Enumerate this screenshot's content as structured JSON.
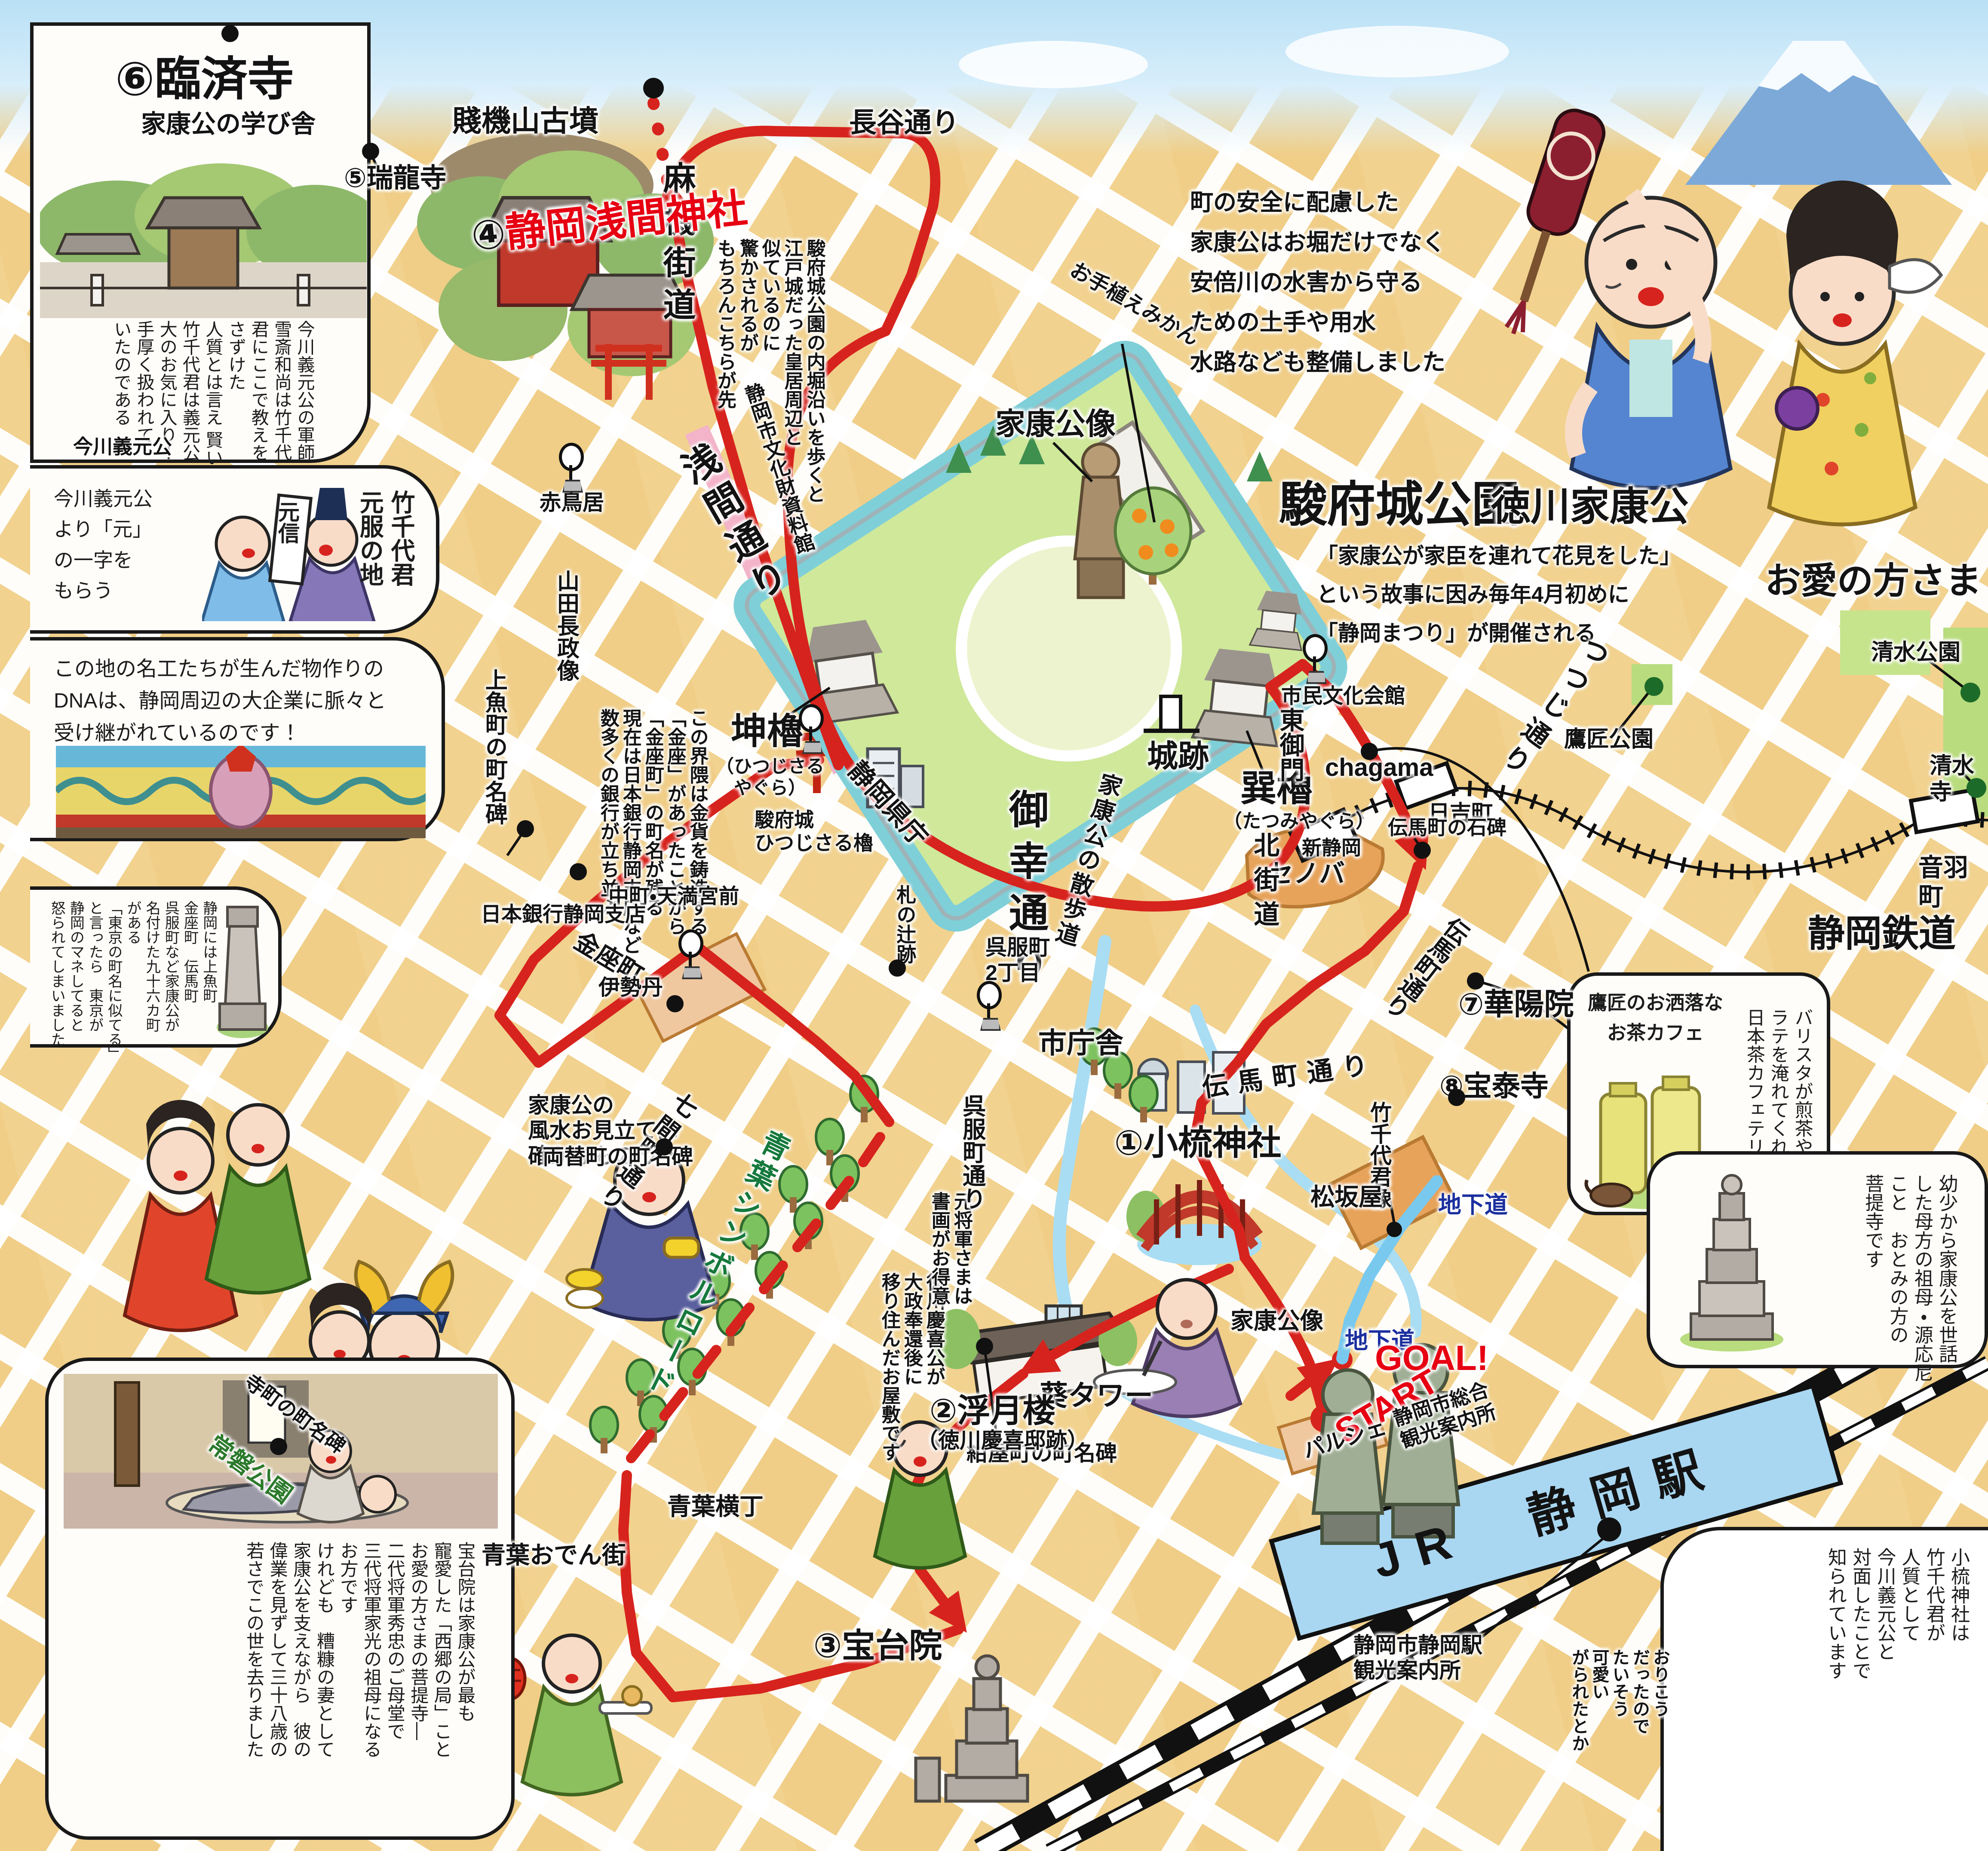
{
  "colors": {
    "route_red": "#d7231d",
    "accent_red": "#e60012",
    "label_blue": "#1b2f9e",
    "road_green": "#15793c",
    "moat_teal": "#7fcfd8",
    "block_yellow": "#f1d28e",
    "station_blue": "#a9d7f2",
    "cenova_orange": "#e8a35a"
  },
  "route": {
    "start": "START",
    "goal": "GOAL!"
  },
  "labels": {
    "kofun": "賤機山古墳",
    "hase": "長谷通り",
    "asahata": "麻機街道",
    "zuiryuji": "⑤瑞龍寺",
    "sengen_num": "④",
    "sengen": "静岡浅間神社",
    "sengen_dori": "浅間通り",
    "akatorii": "赤鳥居",
    "yamada": "山田長政像",
    "bunkazai": "静岡市文化財資料館",
    "uoichi": "上魚町の町名碑",
    "nakacho": "中町・天満宮前",
    "kinzacho": "金座町",
    "nichigin": "日本銀行静岡支店",
    "mikan": "お手植えみかん",
    "ieyasuzo_park": "家康公像",
    "sunpu": "駿府城公園",
    "shiroato": "城跡",
    "sanpo": "家康公の散歩道",
    "hitsujisaru": "坤櫓",
    "hitsujisaru_kana": "（ひつじさる\nやぐら）",
    "hitsujisaru_yagura": "駿府城\nひつじさる櫓",
    "tatsumi": "巽櫓",
    "tatsumi_kana": "（たつみやぐら）",
    "higashigomon": "東御門",
    "shimin": "市民文化会館",
    "miyuki": "御幸通り",
    "kencho": "静岡県庁",
    "shichosha": "市庁舎",
    "fudanotsuji": "札の辻跡",
    "isetan": "伊勢丹",
    "gofuku2": "呉服町\n2丁目",
    "gofuku_dori": "呉服町通り",
    "shichiken": "七間町通り",
    "ryogae": "両替町の町名碑",
    "aoba_road": "青葉シンボルロード",
    "aoba_yokocho": "青葉横丁",
    "aoba_oden": "青葉おでん街",
    "teramachi": "寺町の町名碑",
    "tokiwa": "常磐公園",
    "ieyasu_chara": "徳川家康公",
    "oai_chara": "お愛の方さま",
    "shimizu_park": "清水公園",
    "shimizudera": "清水寺",
    "otowa": "音羽町",
    "tetsudo": "静岡鉄道",
    "takajo": "鷹匠公園",
    "tsutsuji": "つつじ通り",
    "chagama": "chagama",
    "hiyoshi": "日吉町",
    "tenma_sekihi": "伝馬町の石碑",
    "kayoin": "⑦華陽院",
    "shin_shizuoka": "新静岡",
    "cenova": "セノバ",
    "kitakaido": "北街道",
    "tenma_dori": "伝馬町通り",
    "hotaiji": "⑧宝泰寺",
    "takechiyo_zo": "竹千代君像",
    "matsuzakaya": "松坂屋",
    "chikado_a": "地下道",
    "chikado_b": "地下道",
    "goal": "GOAL!",
    "start": "START",
    "sogo_annai": "静岡市総合\n観光案内所",
    "parche": "パルシェ",
    "jr_eki": "JR　静岡駅",
    "eki_annai": "静岡市静岡駅\n観光案内所",
    "aoi_tower": "葵タワー",
    "konya": "紺屋町の町名碑",
    "ogushi": "①小梳神社",
    "fugetsuro": "②浮月楼",
    "fugetsuro_kana": "（徳川慶喜邸跡）",
    "hodaiin": "③宝台院",
    "ieyasuzo_eki": "家康公像",
    "rinzaiji_caption": "今川義元公"
  },
  "panels": {
    "rinzaiji": {
      "title": "⑥臨済寺",
      "subtitle": "家康公の学び舎",
      "body": "今川義元公の軍師\n雪斎和尚は竹千代\n君にここで教えを\nさずけた\n人質とは言え 賢い\n竹千代君は義元公\n大のお気に入り！\n手厚く扱われて\nいたのである"
    },
    "genpuku": {
      "caption": "今川義元公\nより「元」\nの一字を\nもらう",
      "title": "竹千代君\n元服の地",
      "scroll": "元信"
    },
    "dna": {
      "body": "この地の名工たちが生んだ物作りの\nDNAは、静岡周辺の大企業に脈々と\n受け継がれているのです！"
    },
    "chomei": {
      "body": "静岡には上魚町\n金座町　伝馬町\n呉服町など家康公が\n名付けた九十六カ町\nがある\n「東京の町名に似てる」\nと言ったら　東京が\n静岡のマネしてると\n怒られてしまいました"
    },
    "hodaiin_story": {
      "body": "宝台院は家康公が最も\n寵愛した「西郷の局」こと\nお愛の方さまの菩提寺―\n二代将軍秀忠のご母堂で\n三代将軍家光の祖母になる\nお方です\nけれども　糟糠の妻として\n家康公を支えながら　彼の\n偉業を見ずして三十八歳の\n若さでこの世を去りました"
    },
    "tea_cafe": {
      "title": "鷹匠のお洒落な\nお茶カフェ",
      "body": "バリスタが煎茶や\nラテを淹れてくれる\n日本茶カフェテリア"
    },
    "genoni": {
      "body": "幼少から家康公を世話\nした母方の祖母・源応尼\nこと　おとみの方の\n菩提寺です"
    },
    "ogushi_note": {
      "body": "小梳神社は\n竹千代君が\n人質として\n今川義元公と\n対面したことで\n知られています"
    },
    "okoriko": {
      "body": "おりこう\nだったので\nたいそう\n可愛い\nがられたとか"
    },
    "anzen": {
      "body": "町の安全に配慮した\n家康公はお堀だけでなく\n安倍川の水害から守る\nための土手や用水\n水路なども整備しました"
    },
    "matsuri": {
      "body": "「家康公が家臣を連れて花見をした」\nという故事に因み毎年4月初めに\n「静岡まつり」が開催される"
    },
    "uchibori": {
      "body": "駿府城公園の内堀沿いを歩くと\n江戸城だった皇居周辺と\n似ているのに\n驚かされるが\nもちろんこちらが先"
    },
    "kinza": {
      "body": "この界隈は金貨を鋳造する\n「金座」があったことから\n「金座町」の町名が残る\n現在は日本銀行静岡支店など\n数多くの銀行が立ち並ぶ"
    },
    "fusui": {
      "body": "家康公の\n風水お見立ては\n確かなもの"
    },
    "keiki": {
      "body": "徳川慶喜公が\n大政奉還後に\n移り住んだお屋敷です"
    },
    "shoga": {
      "body": "元将軍さまは\n書画がお得意"
    }
  }
}
